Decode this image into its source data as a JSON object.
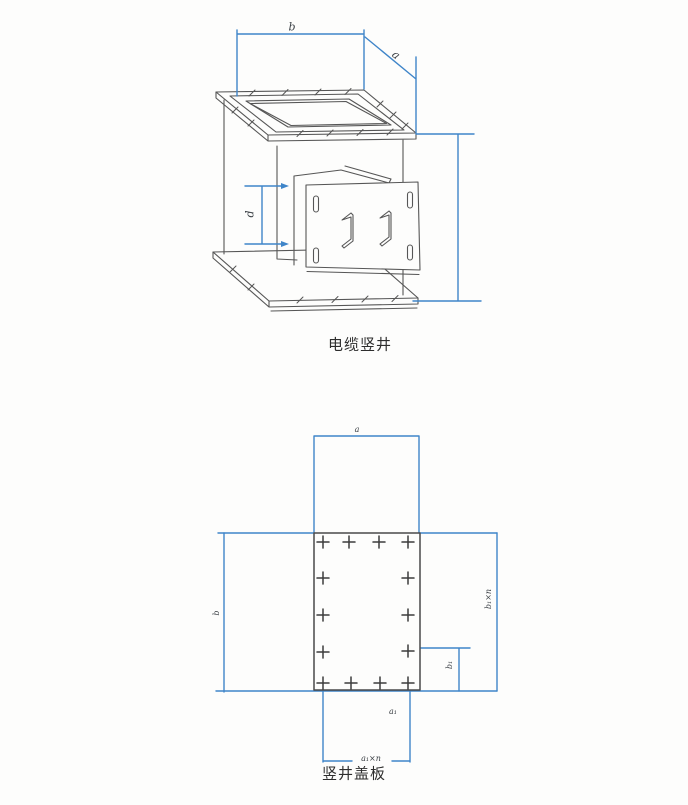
{
  "colors": {
    "dimension_line": "#3f85c9",
    "drawing_line": "#565656",
    "caption_text": "#2d2d2d",
    "background": "#fdfdfc"
  },
  "shaft_diagram": {
    "caption": "电缆竖井",
    "dim_width_label": "b",
    "dim_depth_label": "a",
    "dim_door_offset_label": "d"
  },
  "cover_diagram": {
    "caption": "竖井盖板",
    "dim_top_width_label": "a",
    "dim_left_height_label": "b",
    "dim_right_total_label": "b₁×n",
    "dim_right_single_label": "b₁",
    "dim_bottom_single_label": "a₁",
    "dim_bottom_total_label": "a₁×n"
  }
}
